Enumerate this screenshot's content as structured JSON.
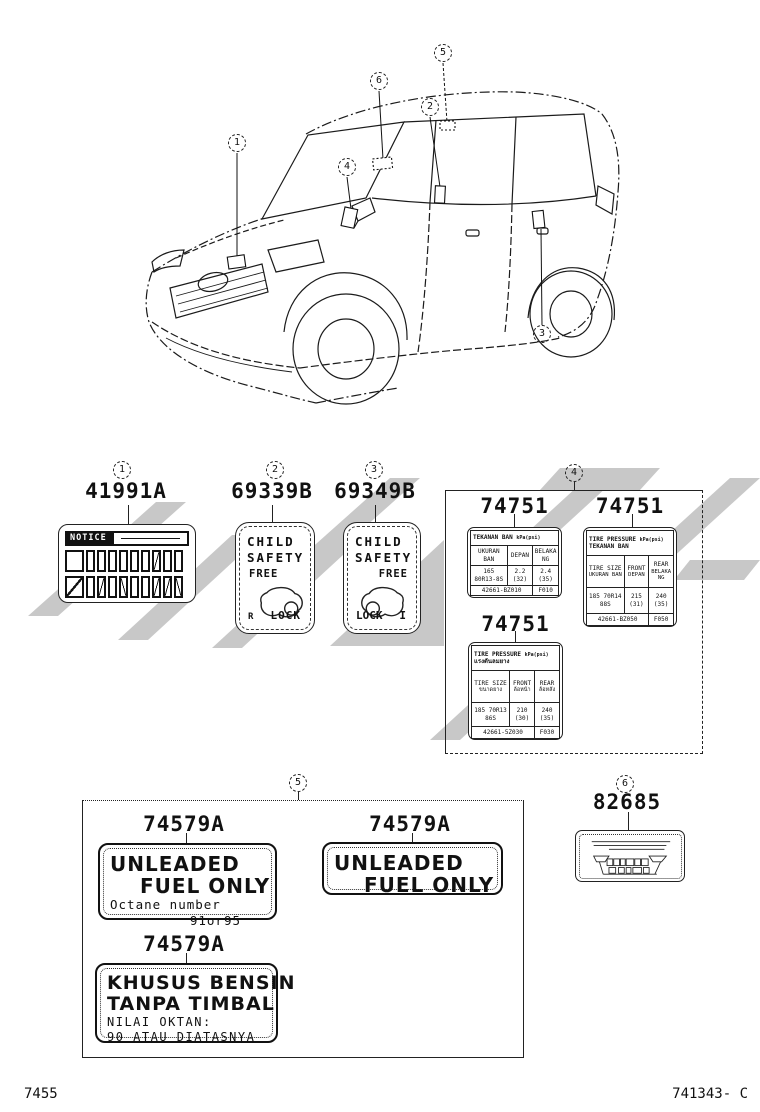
{
  "callouts": {
    "n1": "1",
    "n2": "2",
    "n3": "3",
    "n4": "4",
    "n5": "5",
    "n6": "6"
  },
  "s1": {
    "part_no": "41991A",
    "notice": "NOTICE"
  },
  "s2": {
    "part_no": "69339B",
    "line1": "CHILD",
    "line2": "SAFETY",
    "free": "FREE",
    "lock": "LOCK",
    "mark": "R"
  },
  "s3": {
    "part_no": "69349B",
    "line1": "CHILD",
    "line2": "SAFETY",
    "free": "FREE",
    "lock": "LOCK",
    "mark": "I"
  },
  "s4": {
    "labels": [
      {
        "part_no": "74751",
        "title": "TEKANAN BAN",
        "unit": "kPa(psi)",
        "c1": "UKURAN BAN",
        "c2": "DEPAN",
        "c3": "BELAKANG",
        "size": "165 80R13-8S",
        "front": "2.2 (32)",
        "rear": "2.4 (35)",
        "code": "42661-BZ010",
        "suffix": "F010"
      },
      {
        "part_no": "74751",
        "title": "TIRE PRESSURE",
        "unit": "kPa(psi)",
        "subtitle": "TEKANAN BAN",
        "c1": "TIRE SIZE",
        "c1b": "UKURAN BAN",
        "c2": "FRONT",
        "c2b": "DEPAN",
        "c3": "REAR",
        "c3b": "BELAKANG",
        "size": "185 70R14 88S",
        "front": "215 (31)",
        "rear": "240 (35)",
        "code": "42661-BZ050",
        "suffix": "F050"
      },
      {
        "part_no": "74751",
        "title": "TIRE PRESSURE",
        "unit": "kPa(psi)",
        "subtitle": "แรงดันลมยาง",
        "c1": "TIRE SIZE",
        "c1b": "ขนาดยาง",
        "c2": "FRONT",
        "c2b": "ล้อหน้า",
        "c3": "REAR",
        "c3b": "ล้อหลัง",
        "size": "185 70R13 86S",
        "front": "210 (30)",
        "rear": "240 (35)",
        "code": "42661-5Z030",
        "suffix": "F030"
      }
    ]
  },
  "s5": {
    "labels": [
      {
        "part_no": "74579A",
        "line1": "UNLEADED",
        "line2": "FUEL ONLY",
        "line3": "Octane number",
        "line4": "91or95"
      },
      {
        "part_no": "74579A",
        "line1": "UNLEADED",
        "line2": "FUEL ONLY"
      },
      {
        "part_no": "74579A",
        "line1": "KHUSUS BENSIN",
        "line2": "TANPA TIMBAL",
        "line3": "NILAI OKTAN:",
        "line4": "90 ATAU DIATASNYA"
      }
    ]
  },
  "s6": {
    "part_no": "82685"
  },
  "footer": {
    "left": "7455",
    "right": "741343- C"
  }
}
